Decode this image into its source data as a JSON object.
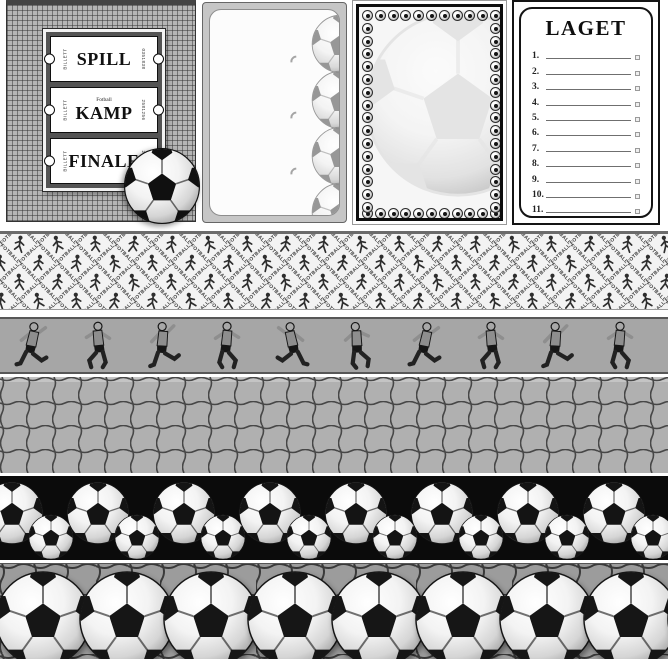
{
  "colors": {
    "ink": "#101010",
    "net_gray": "#b0b0b0",
    "players_strip_bg": "#a6a6a6",
    "black_strip_bg": "#0b0b0b"
  },
  "tickets_panel": {
    "tickets": [
      {
        "label": "SPILL",
        "header": "",
        "side_left": "BILLETT",
        "side_right": "0351838"
      },
      {
        "label": "KAMP",
        "header": "Fotball",
        "side_left": "BILLETT",
        "side_right": "2581256"
      },
      {
        "label": "FINALE",
        "header": "",
        "side_left": "BILLETT",
        "side_right": "2581582"
      }
    ]
  },
  "journal_card": {
    "edge_ball_count": 4
  },
  "frame_card": {
    "watermark": "soccer-ball"
  },
  "laget_card": {
    "title": "LAGET",
    "rows": [
      "1.",
      "2.",
      "3.",
      "4.",
      "5.",
      "6.",
      "7.",
      "8.",
      "9.",
      "10.",
      "11."
    ]
  },
  "strips": {
    "lattice": {
      "word": "FOTBALL",
      "rows": 5,
      "cols": 19
    },
    "players": {
      "count": 10
    },
    "balls_on_black": {
      "large_count": 9,
      "small_count": 8
    },
    "large_balls": {
      "count": 9
    }
  }
}
